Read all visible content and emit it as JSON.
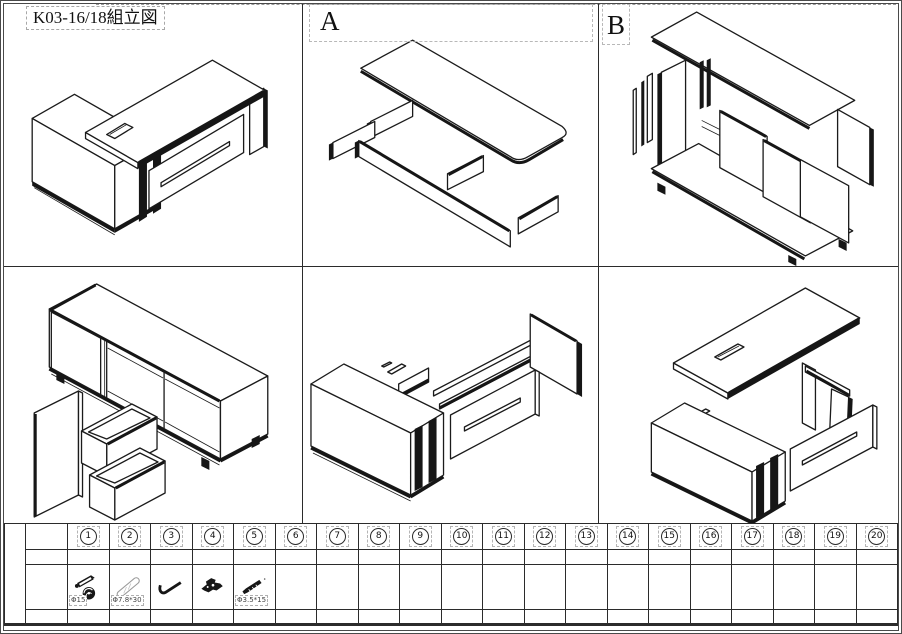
{
  "title": "K03-16/18組立図",
  "panel_labels": {
    "a": "A",
    "b": "B"
  },
  "parts_table": {
    "columns": [
      "1",
      "2",
      "3",
      "4",
      "5",
      "6",
      "7",
      "8",
      "9",
      "10",
      "11",
      "12",
      "13",
      "14",
      "15",
      "16",
      "17",
      "18",
      "19",
      "20"
    ],
    "parts": [
      {
        "column": "1",
        "icon": "cam-bolt-and-cam-lock",
        "label": "Φ15"
      },
      {
        "column": "2",
        "icon": "wood-dowel",
        "label": "Φ7.8*30"
      },
      {
        "column": "3",
        "icon": "allen-key",
        "label": ""
      },
      {
        "column": "4",
        "icon": "cam-connector",
        "label": ""
      },
      {
        "column": "5",
        "icon": "self-tapping-screw",
        "label": "Φ3.5*15"
      }
    ]
  }
}
